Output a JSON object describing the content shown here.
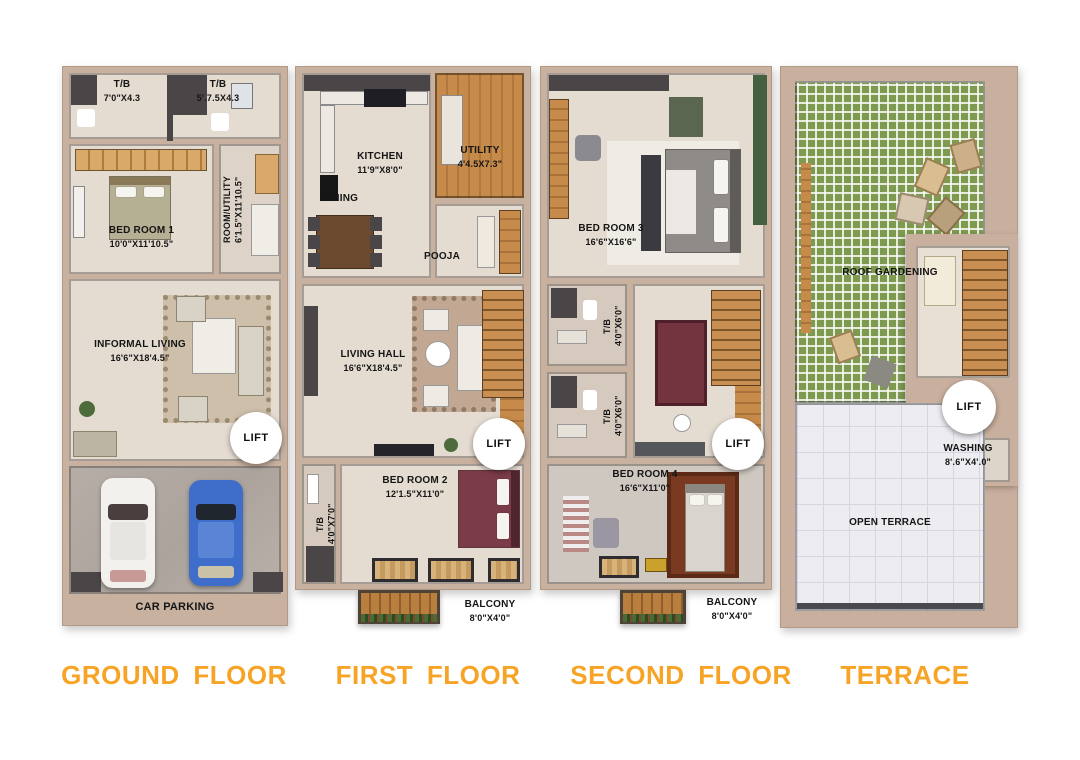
{
  "colors": {
    "title_accent": "#F7A426",
    "wall": "#C9B19F",
    "floor": "#E4DBD1",
    "wood": "#C68B4B",
    "grass": "#7E9A4F",
    "car_blue": "#3E6EC9"
  },
  "floors": [
    {
      "title": "GROUND FLOOR",
      "labels": {
        "tb_left": {
          "name": "T/B",
          "dims": "7'0\"X4.3"
        },
        "tb_right": {
          "name": "T/B",
          "dims": "5'.7.5X4.3"
        },
        "bedroom1": {
          "name": "BED ROOM 1",
          "dims": "10'0\"X11'10.5\""
        },
        "room_utility": {
          "name": "ROOM/UTILITY",
          "dims": "6'1.5\"X11'10.5\""
        },
        "informal_living": {
          "name": "INFORMAL LIVING",
          "dims": "16'6\"X18'4.5\""
        },
        "lift": "LIFT",
        "car_parking": "CAR PARKING"
      }
    },
    {
      "title": "FIRST FLOOR",
      "labels": {
        "kitchen": {
          "name": "KITCHEN",
          "dims": "11'9\"X8'0\""
        },
        "dining": "DINING",
        "utility": {
          "name": "UTILITY",
          "dims": "4'4.5X7.3\""
        },
        "pooja": "POOJA",
        "living_hall": {
          "name": "LIVING HALL",
          "dims": "16'6\"X18'4.5\""
        },
        "tb": {
          "name": "T/B",
          "dims": "4'0\"X7'0\""
        },
        "bedroom2": {
          "name": "BED ROOM 2",
          "dims": "12'1.5\"X11'0\""
        },
        "balcony": {
          "name": "BALCONY",
          "dims": "8'0\"X4'0\""
        },
        "lift": "LIFT"
      }
    },
    {
      "title": "SECOND FLOOR",
      "labels": {
        "bedroom3": {
          "name": "BED ROOM 3",
          "dims": "16'6\"X16'6\""
        },
        "tb_upper": {
          "name": "T/B",
          "dims": "4'0\"X6'0\""
        },
        "tb_lower": {
          "name": "T/B",
          "dims": "4'0\"X6'0\""
        },
        "bedroom4": {
          "name": "BED ROOM 4",
          "dims": "16'6\"X11'0\""
        },
        "balcony": {
          "name": "BALCONY",
          "dims": "8'0\"X4'0\""
        },
        "lift": "LIFT"
      }
    },
    {
      "title": "TERRACE",
      "labels": {
        "roof_gardening": "ROOF GARDENING",
        "washing": {
          "name": "WASHING",
          "dims": "8'.6\"X4'.0\""
        },
        "open_terrace": "OPEN TERRACE",
        "lift": "LIFT"
      }
    }
  ]
}
